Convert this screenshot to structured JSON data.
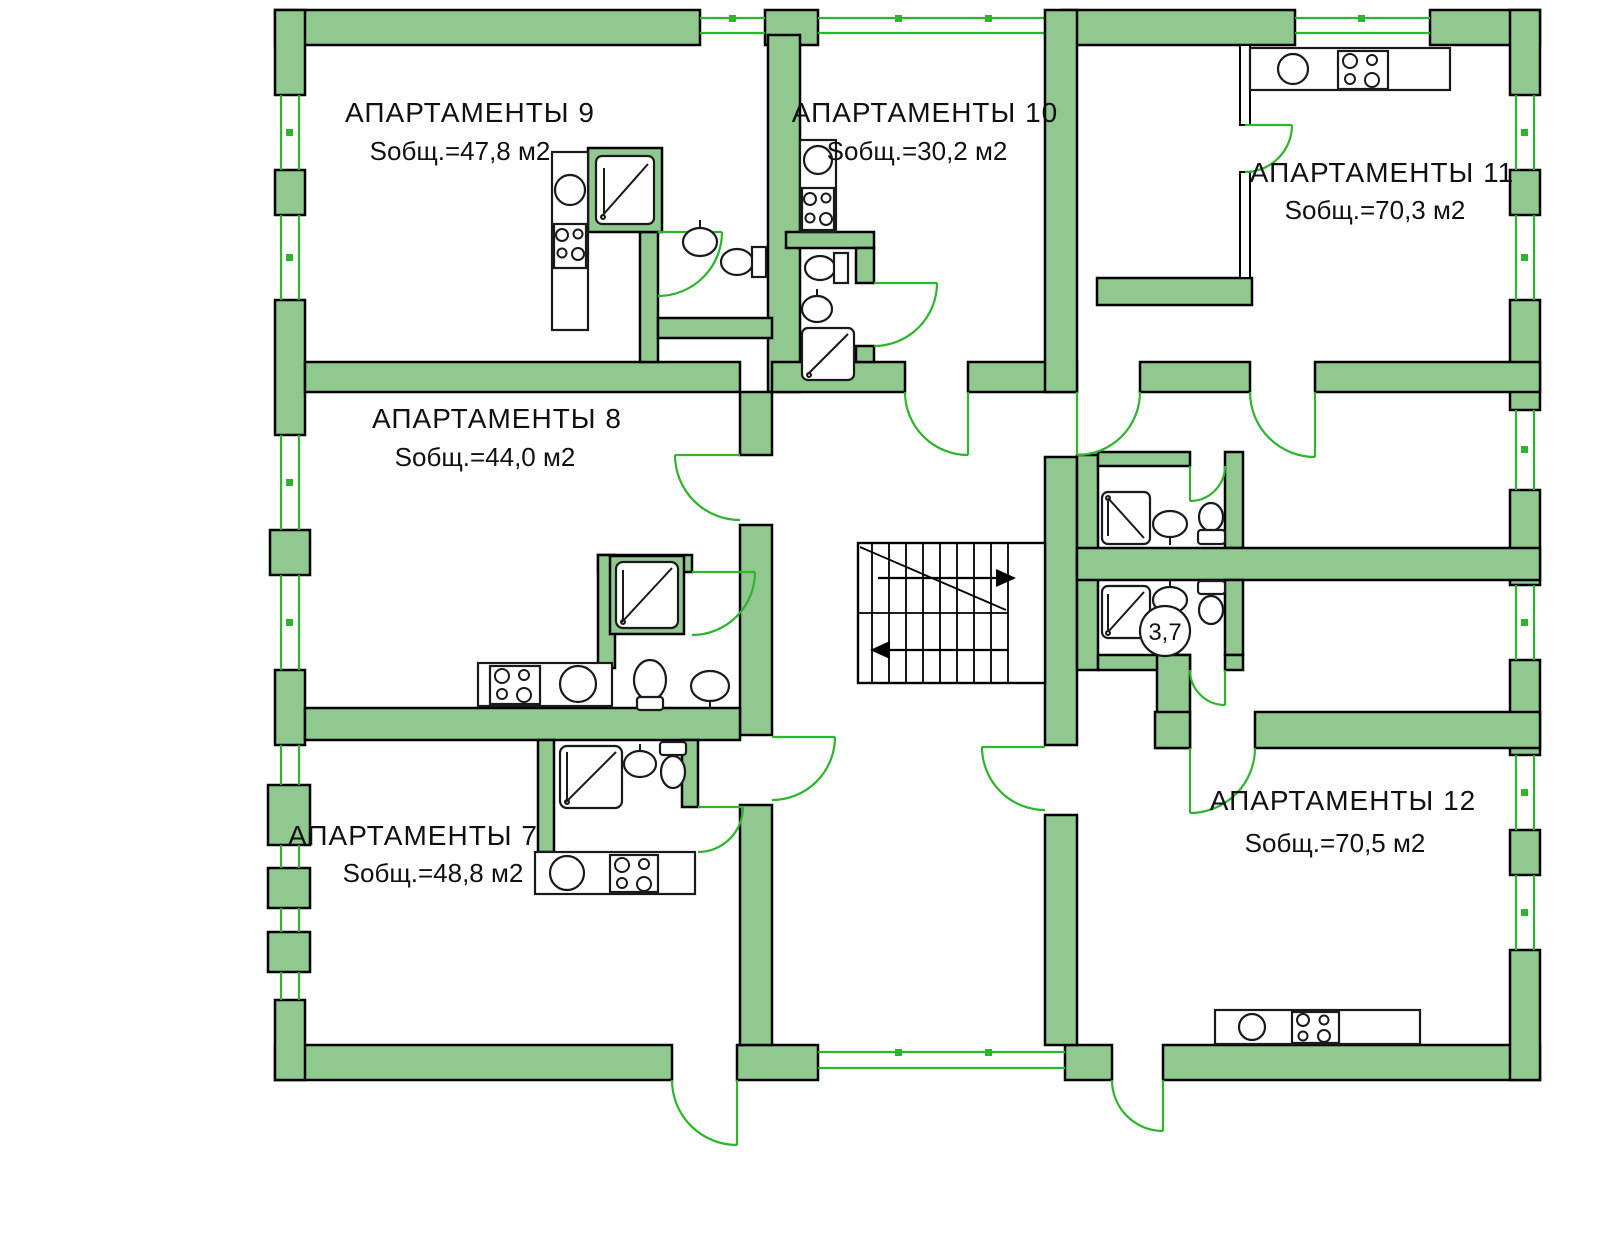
{
  "plan": {
    "title": "Floor plan — apartments level",
    "apartments": [
      {
        "id": "apt-9",
        "name": "АПАРТАМЕНТЫ 9",
        "area": "Sобщ.=47,8 м2"
      },
      {
        "id": "apt-10",
        "name": "АПАРТАМЕНТЫ 10",
        "area": "Sобщ.=30,2 м2"
      },
      {
        "id": "apt-11",
        "name": "АПАРТАМЕНТЫ 11",
        "area": "Sобщ.=70,3 м2"
      },
      {
        "id": "apt-8",
        "name": "АПАРТАМЕНТЫ 8",
        "area": "Sобщ.=44,0 м2"
      },
      {
        "id": "apt-7",
        "name": "АПАРТАМЕНТЫ 7",
        "area": "Sобщ.=48,8 м2"
      },
      {
        "id": "apt-12",
        "name": "АПАРТАМЕНТЫ 12",
        "area": "Sобщ.=70,5 м2"
      }
    ],
    "bathroom_area_label": "3,7",
    "colors": {
      "wall_fill": "#90c890",
      "wall_outline": "#000000",
      "door_window_green": "#2db52d",
      "fixture_outline": "#1a1a1a",
      "background": "#ffffff"
    }
  }
}
